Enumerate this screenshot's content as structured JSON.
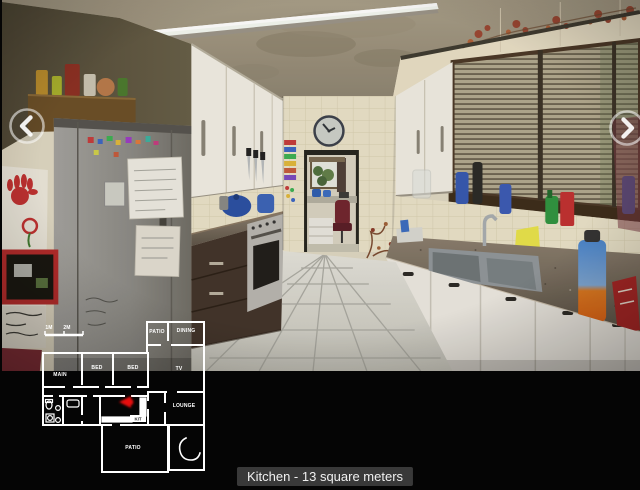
{
  "viewer": {
    "caption": "Kitchen - 13 square meters",
    "caption_bg_color": "#3e3e3e",
    "caption_text_color": "#f0f0f0",
    "background_color": "#000000",
    "nav": {
      "prev_icon": "chevron-left",
      "next_icon": "chevron-right"
    }
  },
  "floorplan": {
    "scale_labels": [
      "1M",
      "2M"
    ],
    "rooms": [
      {
        "label": "MAIN"
      },
      {
        "label": "BED"
      },
      {
        "label": "BED"
      },
      {
        "label": "PATIO"
      },
      {
        "label": "DINING"
      },
      {
        "label": "TV"
      },
      {
        "label": "LOUNGE"
      },
      {
        "label": "KIT"
      },
      {
        "label": "PATIO"
      }
    ],
    "wall_color": "#ffffff",
    "marker_color": "#e81010"
  }
}
